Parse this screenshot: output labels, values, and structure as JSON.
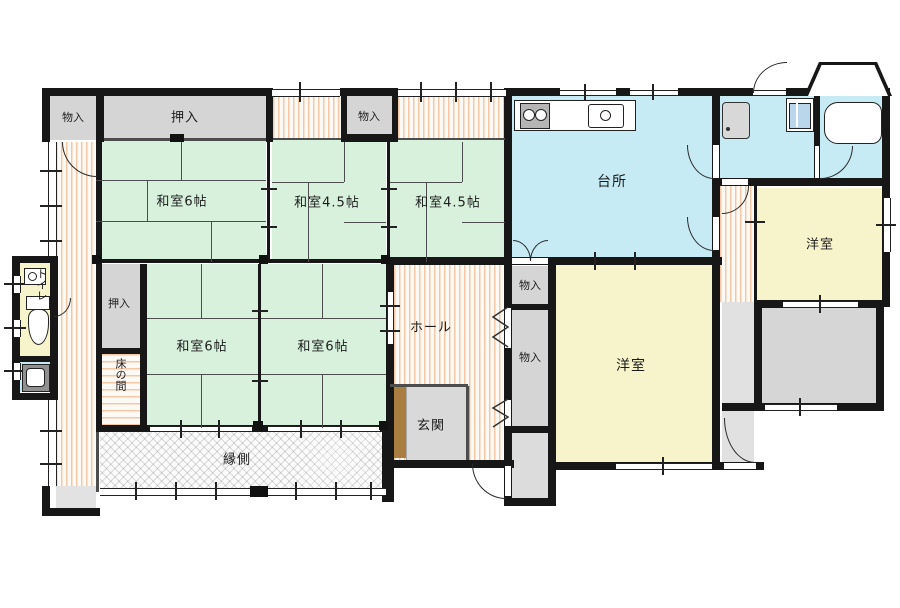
{
  "rooms": {
    "storage_top_left": "物入",
    "closet_top": "押入",
    "storage_top_mid": "物入",
    "tatami6_top": "和室6帖",
    "tatami45_left": "和室4.5帖",
    "tatami45_right": "和室4.5帖",
    "kitchen": "台所",
    "western_top_right": "洋室",
    "closet_left": "押入",
    "tokonoma": "床の間",
    "tatami6_left": "和室6帖",
    "tatami6_right": "和室6帖",
    "hall": "ホール",
    "storage_hall_upper": "物入",
    "storage_hall_lower": "物入",
    "western_main": "洋室",
    "entrance": "玄関",
    "veranda": "縁側",
    "toilet": "トイレ"
  },
  "colors": {
    "tatami": "#d7f1dc",
    "water_rooms": "#c7ebf5",
    "western_rooms": "#f7f4cb",
    "storage": "#d5d5d5",
    "wood_floor_stripe": "#eea670",
    "entrance_step": "#a97e40",
    "walls": "#171717"
  },
  "icons": {
    "stove": "two burner circles",
    "kitchen_sink": "counter basin with faucet",
    "washing_machine": "square drum",
    "washbasin": "vanity basin",
    "bathtub": "rounded tub",
    "toilet": "tank and bowl",
    "utility_sink": "small dark sink"
  }
}
